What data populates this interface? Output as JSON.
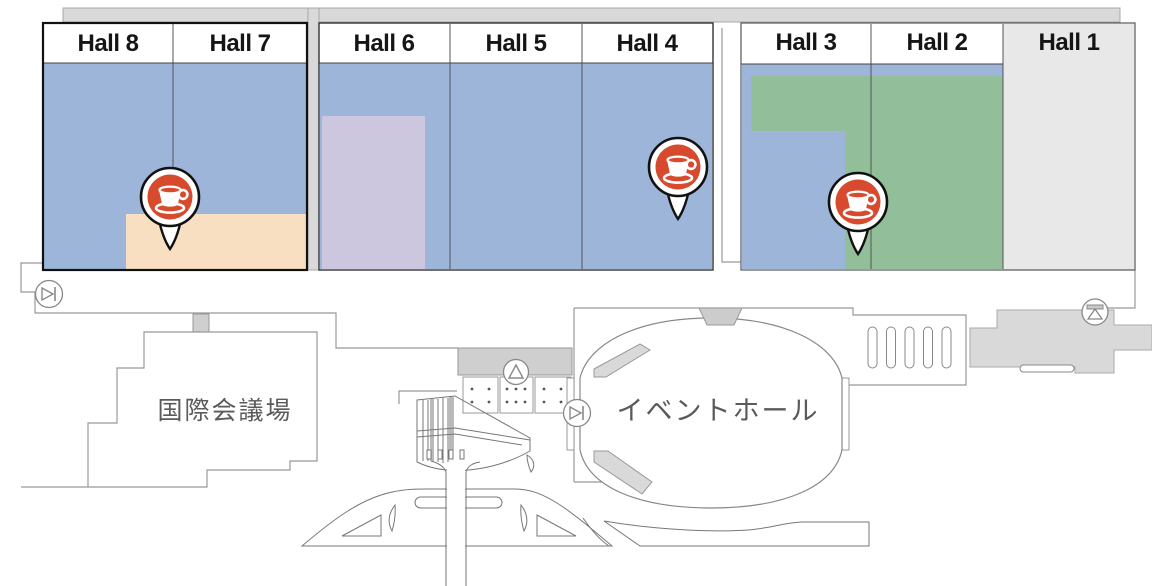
{
  "map_title": "Exhibition halls floor map",
  "halls": [
    {
      "id": "hall-8",
      "label": "Hall 8"
    },
    {
      "id": "hall-7",
      "label": "Hall 7"
    },
    {
      "id": "hall-6",
      "label": "Hall 6"
    },
    {
      "id": "hall-5",
      "label": "Hall 5"
    },
    {
      "id": "hall-4",
      "label": "Hall 4"
    },
    {
      "id": "hall-3",
      "label": "Hall 3"
    },
    {
      "id": "hall-2",
      "label": "Hall 2"
    },
    {
      "id": "hall-1",
      "label": "Hall 1"
    }
  ],
  "facilities": {
    "conference_hall": "国際会議場",
    "event_hall": "イベントホール"
  },
  "pins": [
    {
      "id": "cafe-pin-hall-7",
      "icon": "coffee-cup-icon"
    },
    {
      "id": "cafe-pin-hall-4",
      "icon": "coffee-cup-icon"
    },
    {
      "id": "cafe-pin-hall-3",
      "icon": "coffee-cup-icon"
    }
  ],
  "icons": {
    "gate_west": "play-bar-circle-icon",
    "gate_center": "play-bar-circle-icon",
    "stairs_center": "triangle-circle-icon",
    "gate_east": "funnel-circle-icon",
    "cafe": "coffee-cup-icon"
  },
  "colors": {
    "zone_blue": "#9db5d9",
    "zone_green": "#92bf99",
    "zone_lavender": "#cdc6df",
    "zone_peach": "#f8dfc2",
    "hall_closed_gray": "#e8e8e8",
    "pin_red": "#d84a2d",
    "band_gray": "#d9d9d9"
  }
}
